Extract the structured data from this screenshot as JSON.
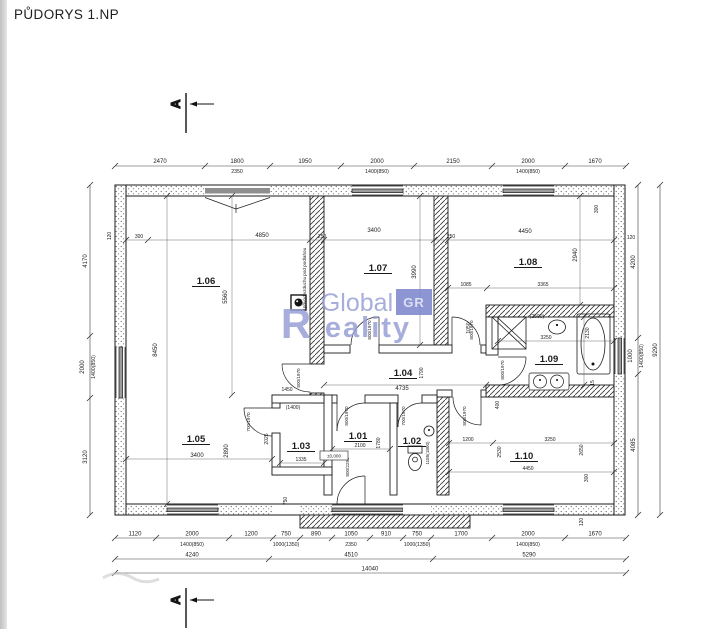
{
  "title": "PŮDORYS 1.NP",
  "section": {
    "label": "A"
  },
  "watermark": {
    "word1": "Global",
    "badge": "GR",
    "word2_cap": "R",
    "word2_rest": "eality"
  },
  "rooms": {
    "r101": "1.01",
    "r102": "1.02",
    "r103": "1.03",
    "r104": "1.04",
    "r105": "1.05",
    "r106": "1.06",
    "r107": "1.07",
    "r108": "1.08",
    "r109": "1.09",
    "r110": "1.10"
  },
  "dims": {
    "top": [
      "2470",
      "1800",
      "1950",
      "2000",
      "2150",
      "2000",
      "1670"
    ],
    "top_sub": [
      "2350",
      "1400(850)",
      "1400(850)"
    ],
    "bottom": [
      "1120",
      "2000",
      "1200",
      "750",
      "890",
      "1050",
      "910",
      "750",
      "1700",
      "2000",
      "1670"
    ],
    "bottom_sub": [
      "1400(850)",
      "1000(1350)",
      "2350",
      "1000(1350)",
      "1400(850)"
    ],
    "bottom2": [
      "4240",
      "4510",
      "5290"
    ],
    "total_w": "14040",
    "left": [
      "4170",
      "2000",
      "3120"
    ],
    "left_sub": "1400(850)",
    "right": [
      "4200",
      "1000",
      "4085"
    ],
    "right_sub": "1400(850)",
    "total_h": "9290"
  },
  "inner": {
    "i300a": "300",
    "i4850": "4850",
    "i250a": "250",
    "i3400t": "3400",
    "i250b": "250",
    "i4450t": "4450",
    "i300tr": "300",
    "i120l": "120",
    "i120r": "120",
    "i120b": "120",
    "i5560": "5560",
    "i8450": "8450",
    "i3990": "3990",
    "i2940": "2940",
    "i1085": "1085",
    "i3365": "3365",
    "i3250bath": "3250",
    "i2130": "2130",
    "i1050": "1050",
    "i4735": "4735",
    "i1790": "1790",
    "i1450": "1450",
    "i3400b": "3400",
    "i2890": "2890",
    "i2100": "2100",
    "i1780": "1780",
    "i1335": "1335",
    "i2025": "2025",
    "i1200": "1200",
    "i3250r": "3250",
    "i2530": "2530",
    "i2650": "2650",
    "i4450b": "4450",
    "i400": "400",
    "i300br": "300",
    "i750": "750",
    "i15": "15",
    "p2500": "(2500)",
    "p1400": "(1400)",
    "i1185": "1185(1800)"
  },
  "doors": {
    "std": "800/1970",
    "small": "700/1970",
    "tall": "800/2250"
  },
  "notes": {
    "air": "přívod vzduchu pod podlahou",
    "level": "±0,000"
  },
  "colors": {
    "ink": "#1b1b1b",
    "watermark": "#99a0d5",
    "badge": "#7b83cc",
    "glazing": "#9d9d9d"
  }
}
